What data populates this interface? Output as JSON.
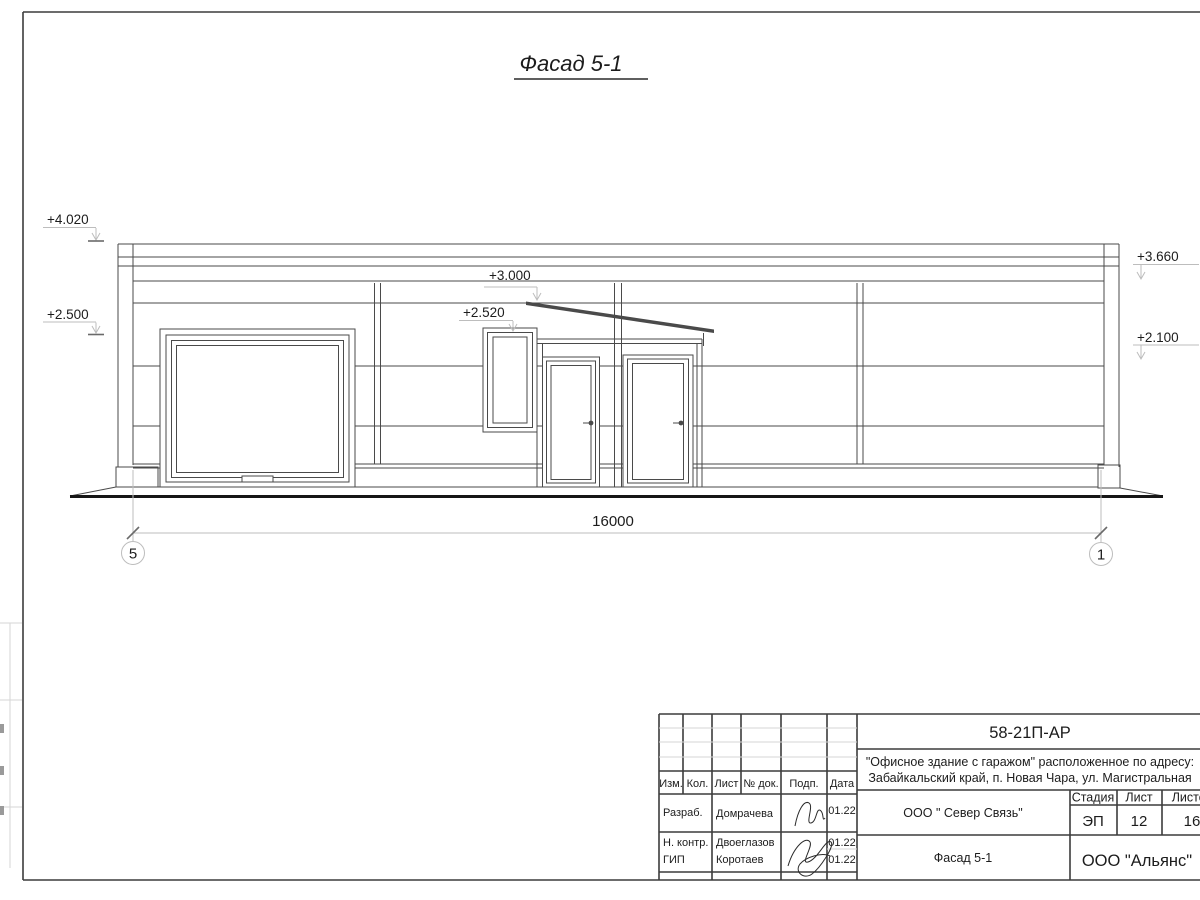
{
  "sheet": {
    "title": "Фасад 5-1"
  },
  "elevations": {
    "left_top": "+4.020",
    "left_bottom": "+2.500",
    "mid_top": "+3.000",
    "mid_bottom": "+2.520",
    "right_top": "+3.660",
    "right_bottom": "+2.100"
  },
  "dimension": {
    "total": "16000"
  },
  "grid": {
    "left": "5",
    "right": "1"
  },
  "titleblock": {
    "code": "58-21П-АР",
    "address_line1": "\"Офисное здание с гаражом\" расположенное по адресу:",
    "address_line2": "Забайкальский край, п. Новая Чара, ул. Магистральная",
    "columns": [
      "Изм.",
      "Кол.",
      "Лист",
      "№ док.",
      "Подп.",
      "Дата"
    ],
    "rows": [
      {
        "role": "Разраб.",
        "name": "Домрачева",
        "date": "01.22"
      },
      {
        "role": "Н. контр.",
        "name": "Двоеглазов",
        "date": "01.22"
      },
      {
        "role": "ГИП",
        "name": "Коротаев",
        "date": "01.22"
      }
    ],
    "org": "ООО \" Север Связь\"",
    "stage_label": "Стадия",
    "sheet_label": "Лист",
    "sheets_label": "Листов",
    "stage": "ЭП",
    "sheet_num": "12",
    "sheets_total": "16",
    "view_name": "Фасад 5-1",
    "company": "ООО \"Альянс\""
  }
}
